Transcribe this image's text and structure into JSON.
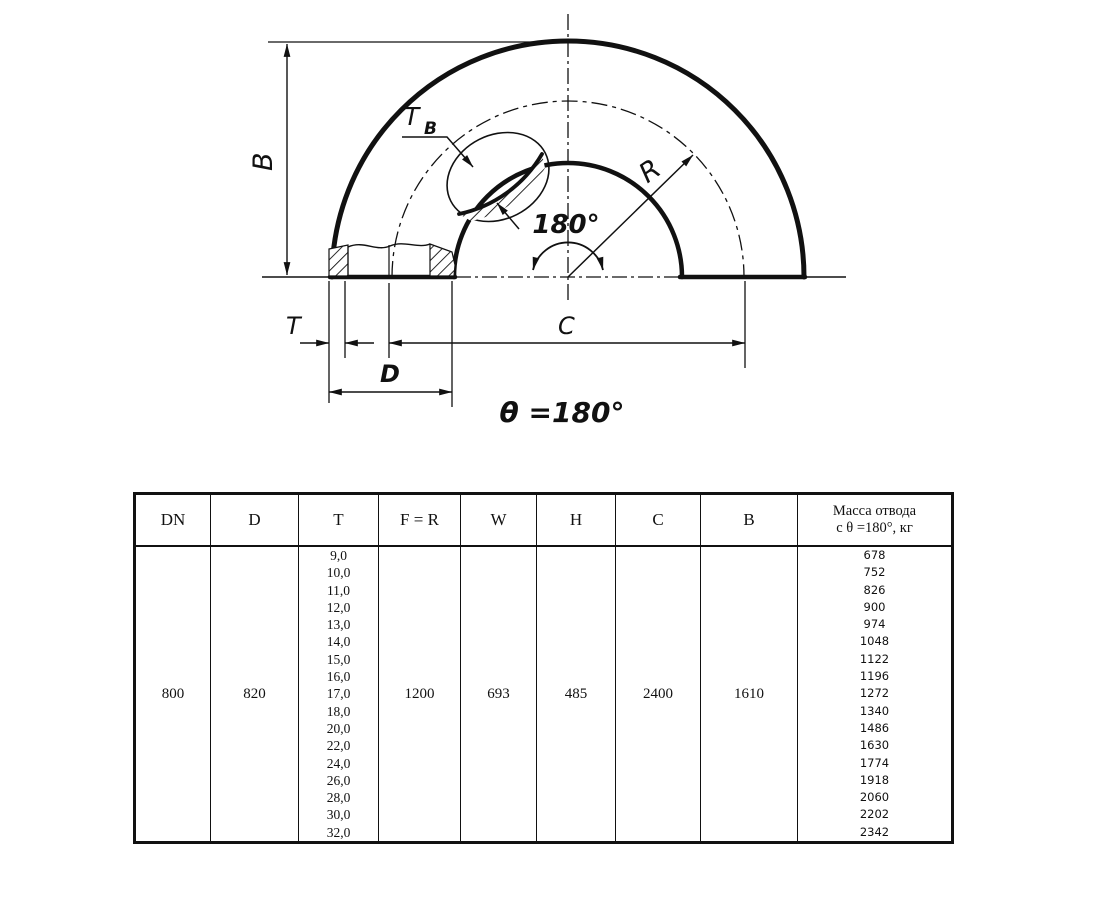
{
  "diagram": {
    "labels": {
      "B": "B",
      "T": "T",
      "D": "D",
      "C": "C",
      "R": "R",
      "Tb_main": "T",
      "Tb_sub": "B",
      "angle": "180°",
      "theta": "θ =180°"
    }
  },
  "table": {
    "headers": [
      "DN",
      "D",
      "T",
      "F = R",
      "W",
      "H",
      "C",
      "B"
    ],
    "mass_header": [
      "Масса отвода",
      "с θ =180°, кг"
    ],
    "values": {
      "dn": "800",
      "d": "820",
      "f_r": "1200",
      "w": "693",
      "h": "485",
      "c": "2400",
      "b": "1610"
    },
    "t_values": [
      "9,0",
      "10,0",
      "11,0",
      "12,0",
      "13,0",
      "14,0",
      "15,0",
      "16,0",
      "17,0",
      "18,0",
      "20,0",
      "22,0",
      "24,0",
      "26,0",
      "28,0",
      "30,0",
      "32,0"
    ],
    "mass_values": [
      "678",
      "752",
      "826",
      "900",
      "974",
      "1048",
      "1122",
      "1196",
      "1272",
      "1340",
      "1486",
      "1630",
      "1774",
      "1918",
      "2060",
      "2202",
      "2342"
    ]
  }
}
